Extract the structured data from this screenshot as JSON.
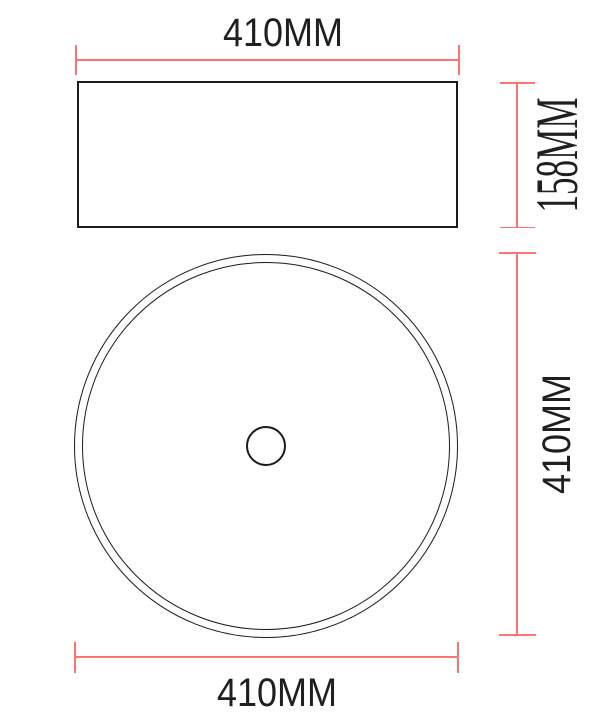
{
  "labels": {
    "top_width": "410MM",
    "side_height": "158MM",
    "diameter": "410MM",
    "bottom_width": "410MM"
  },
  "colors": {
    "dimension_line": "#ff7373",
    "drawing_line": "#1b1b1b",
    "text": "#1f1f1f",
    "background": "#ffffff"
  }
}
